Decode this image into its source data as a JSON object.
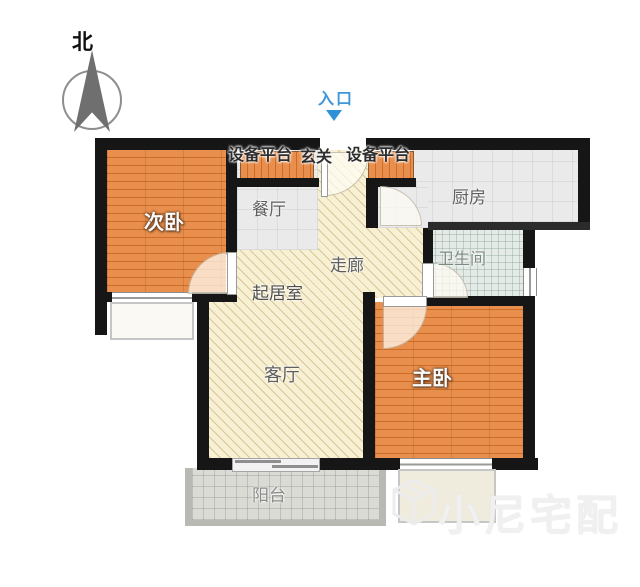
{
  "compass": {
    "label": "北"
  },
  "entrance": {
    "label": "入口"
  },
  "top_labels": {
    "platform_left": "设备平台",
    "foyer": "玄关",
    "platform_right": "设备平台"
  },
  "rooms": {
    "bedroom2": {
      "label": "次卧",
      "floor": "wood"
    },
    "dining": {
      "label": "餐厅",
      "floor": "gray"
    },
    "kitchen": {
      "label": "厨房",
      "floor": "gray"
    },
    "bathroom": {
      "label": "卫生间",
      "floor": "tile"
    },
    "corridor": {
      "label": "走廊",
      "floor": "hatch"
    },
    "sitting": {
      "label": "起居室",
      "floor": "hatch"
    },
    "living": {
      "label": "客厅",
      "floor": "hatch"
    },
    "master": {
      "label": "主卧",
      "floor": "wood"
    },
    "balcony": {
      "label": "阳台",
      "floor": "tile-gray"
    }
  },
  "watermark": {
    "text": "小尼宅配"
  },
  "colors": {
    "wall": "#161616",
    "wood_floor": "#e2833c",
    "hatch_floor": "#f8f0d2",
    "gray_floor": "#eaeaea",
    "bath_tile": "#e4eae6",
    "balcony_tile": "#dbdbd5",
    "entrance_accent": "#2f90d5"
  }
}
